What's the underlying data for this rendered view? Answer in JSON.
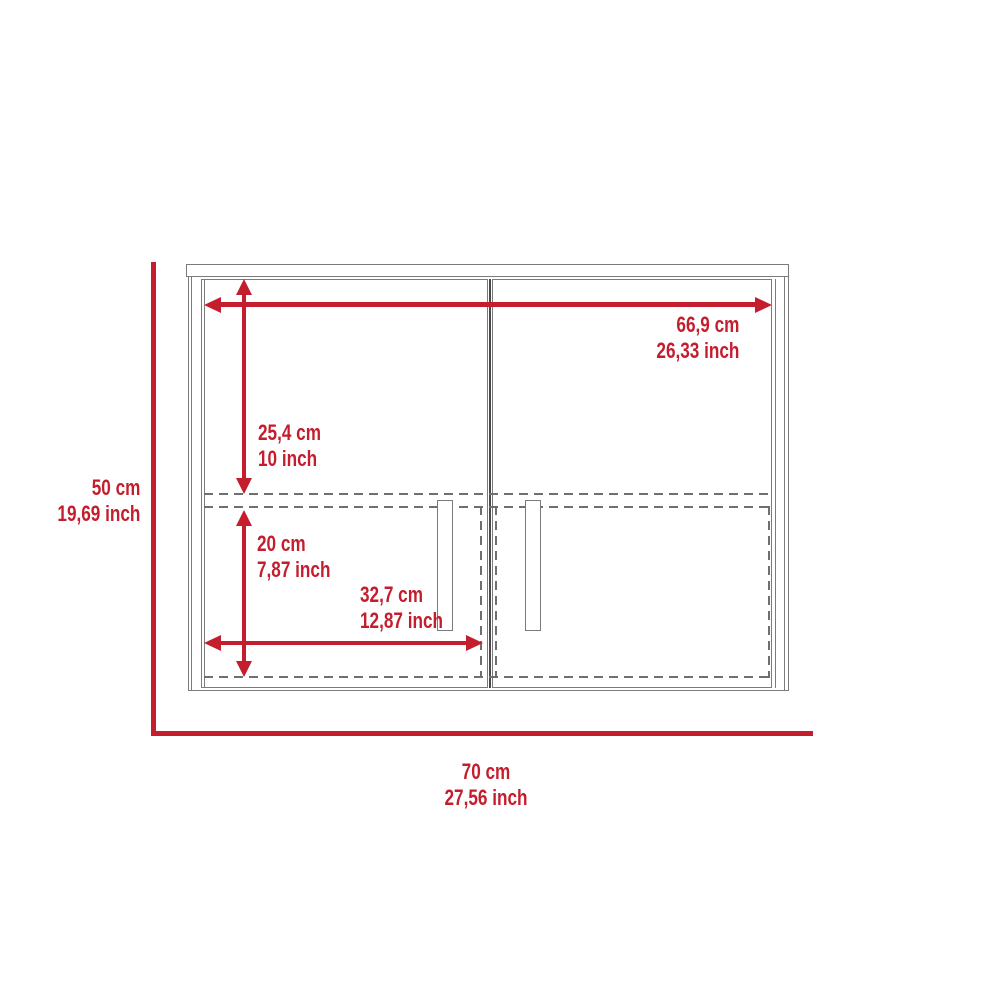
{
  "diagram": {
    "type": "cabinet-dimension-drawing",
    "dims": {
      "top_width": {
        "cm": "66,9 cm",
        "inch": "26,33 inch"
      },
      "upper_height": {
        "cm": "25,4 cm",
        "inch": "10 inch"
      },
      "lower_height": {
        "cm": "20 cm",
        "inch": "7,87 inch"
      },
      "half_width": {
        "cm": "32,7 cm",
        "inch": "12,87 inch"
      },
      "overall_height": {
        "cm": "50 cm",
        "inch": "19,69 inch"
      },
      "overall_width": {
        "cm": "70 cm",
        "inch": "27,56 inch"
      }
    },
    "colors": {
      "dimension_red": "#c41e2e",
      "line_gray": "#7b7b7b",
      "dash_gray": "#6f6f6f",
      "divider_gray": "#4a4a4a",
      "background": "#ffffff"
    }
  }
}
